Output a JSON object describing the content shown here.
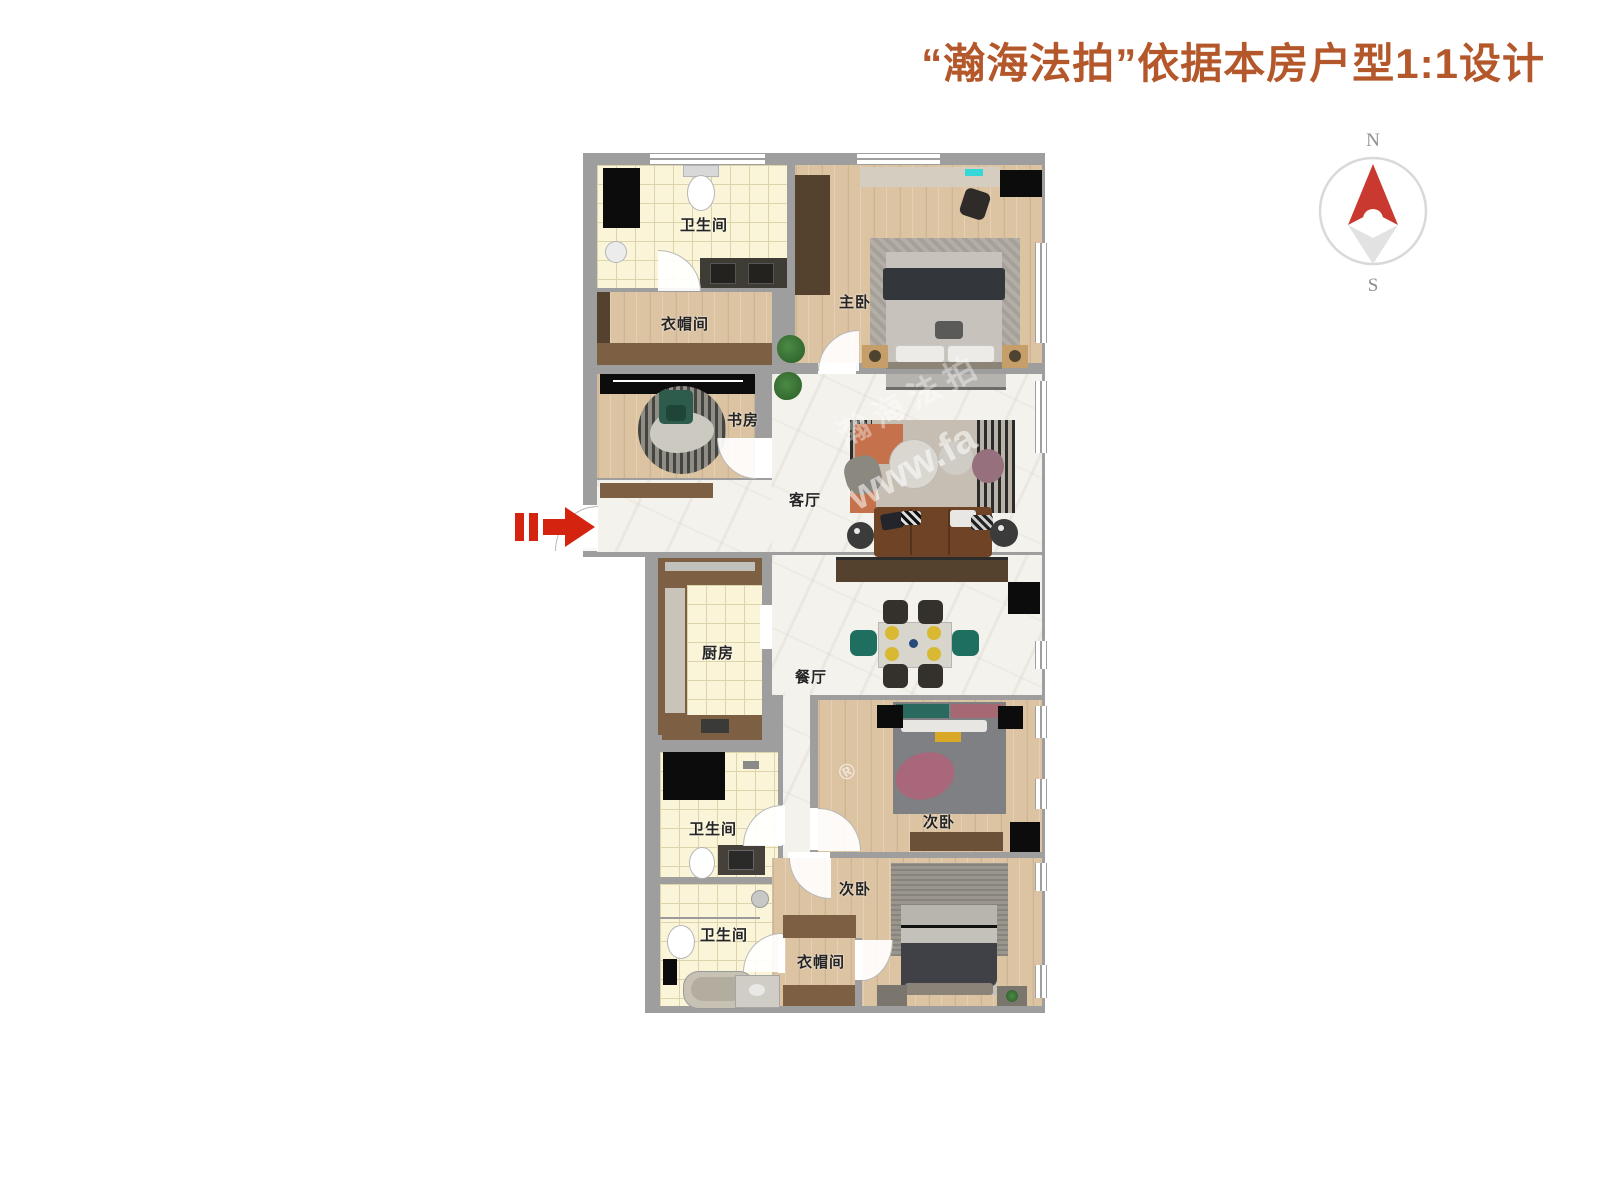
{
  "header": {
    "title": "“瀚海法拍”依据本房户型1:1设计"
  },
  "compass": {
    "north_label": "N",
    "south_label": "S"
  },
  "rooms": {
    "bath_top": {
      "label": "卫生间"
    },
    "cloak_top": {
      "label": "衣帽间"
    },
    "master_bedroom": {
      "label": "主卧"
    },
    "study": {
      "label": "书房"
    },
    "living_room": {
      "label": "客厅"
    },
    "kitchen": {
      "label": "厨房"
    },
    "dining_room": {
      "label": "餐厅"
    },
    "bath_mid": {
      "label": "卫生间"
    },
    "bedroom_mid": {
      "label": "次卧"
    },
    "bath_bottom": {
      "label": "卫生间"
    },
    "bedroom_bottom": {
      "label": "次卧"
    },
    "cloak_bottom": {
      "label": "衣帽间"
    }
  },
  "watermark": {
    "brand": "瀚海法拍",
    "site": "www.fa",
    "reg": "®"
  },
  "colors": {
    "title": "#b4582c",
    "wall": "#9e9e9e",
    "wood": "#dcc3a2",
    "tile": "#faf5d9",
    "tile-line": "#ddd4ab",
    "marble": "#f4f2ec",
    "cabinet": "#7d5f43",
    "cabinet-dark": "#54422f",
    "black": "#0c0c0c",
    "arrow-red": "#d42410",
    "teal": "#1f6f60",
    "compass-red": "#c9392f",
    "compass-gray": "#d9d9d9",
    "label": "#242424"
  }
}
